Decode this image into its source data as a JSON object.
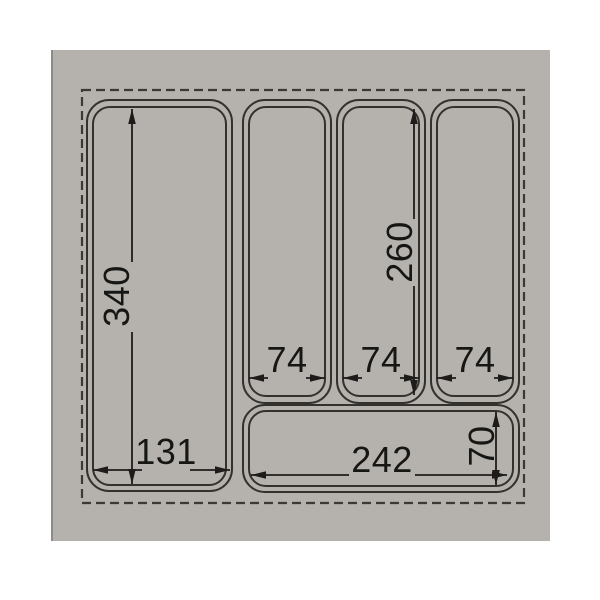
{
  "diagram": {
    "description": "Technical top-view drawing of a drawer cutlery tray insert with five compartments and millimeter dimensions",
    "dimensions": {
      "left_compartment_height": "340",
      "left_compartment_width": "131",
      "slot_1_width": "74",
      "slot_2_width": "74",
      "slot_3_width": "74",
      "slot_height": "260",
      "bottom_compartment_width": "242",
      "bottom_compartment_height": "70"
    },
    "colors": {
      "page_background": "#ffffff",
      "panel_gray": "#b5b2ae",
      "panel_edge_shadow": "#8d8b87",
      "wall_line": "#32312d",
      "dashed_outline": "#3a3935",
      "dimension_line": "#1d1c1a",
      "dimension_text": "#161614"
    }
  }
}
